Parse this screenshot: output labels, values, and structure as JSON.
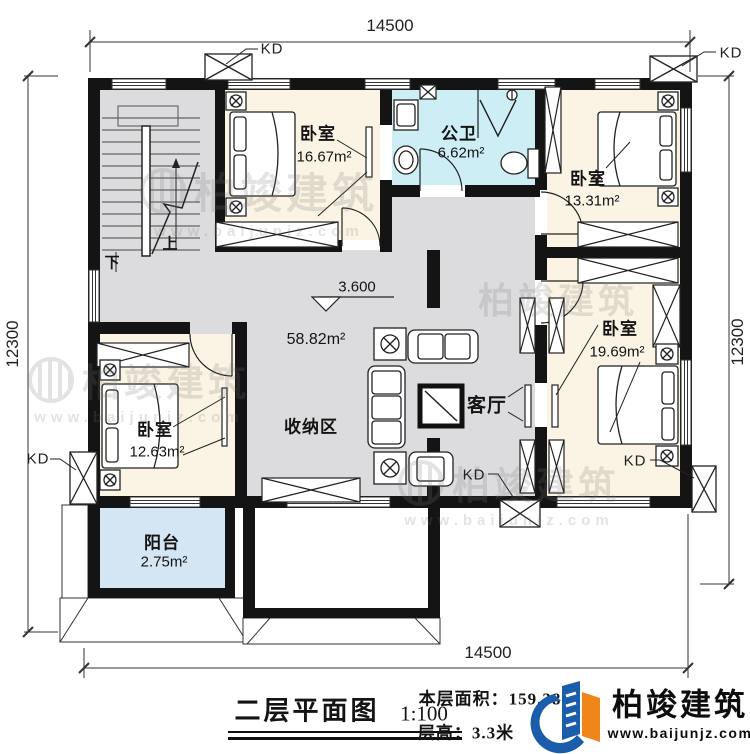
{
  "plan": {
    "title": "二层平面图",
    "scale": "1:100",
    "floor_area": "本层面积：159.38",
    "floor_height": "层高：3.3米",
    "level_mark": "3.600",
    "stairs_up": "上",
    "stairs_down": "下"
  },
  "dimensions": {
    "top": "14500",
    "bottom": "14500",
    "left": "12300",
    "right": "12300"
  },
  "kd": [
    "KD",
    "KD",
    "KD",
    "KD",
    "KD"
  ],
  "rooms": {
    "bedroom_top_left": {
      "name": "卧室",
      "area": "16.67m²"
    },
    "bathroom": {
      "name": "公卫",
      "area": "6.62m²"
    },
    "bedroom_top_right": {
      "name": "卧室",
      "area": "13.31m²"
    },
    "bedroom_right": {
      "name": "卧室",
      "area": "19.69m²"
    },
    "bedroom_bottom_left": {
      "name": "卧室",
      "area": "12.63m²"
    },
    "living": {
      "name": "客厅",
      "area": "58.82m²"
    },
    "storage": {
      "name": "收纳区"
    },
    "balcony": {
      "name": "阳台",
      "area": "2.75m²"
    }
  },
  "brand": {
    "name": "柏竣建筑",
    "website": "www.baijunjz.com"
  },
  "watermark": {
    "text": "柏竣建筑",
    "url": "www.baijunjz.com"
  },
  "colors": {
    "bedroom_floor": "#fbf4e4",
    "bath_floor": "#cdeef5",
    "balcony_floor": "#d4e5f4",
    "hall_floor": "#dcdcde",
    "wall": "#141414",
    "brand_blue": "#1a5dab",
    "brand_orange": "#f08619"
  }
}
